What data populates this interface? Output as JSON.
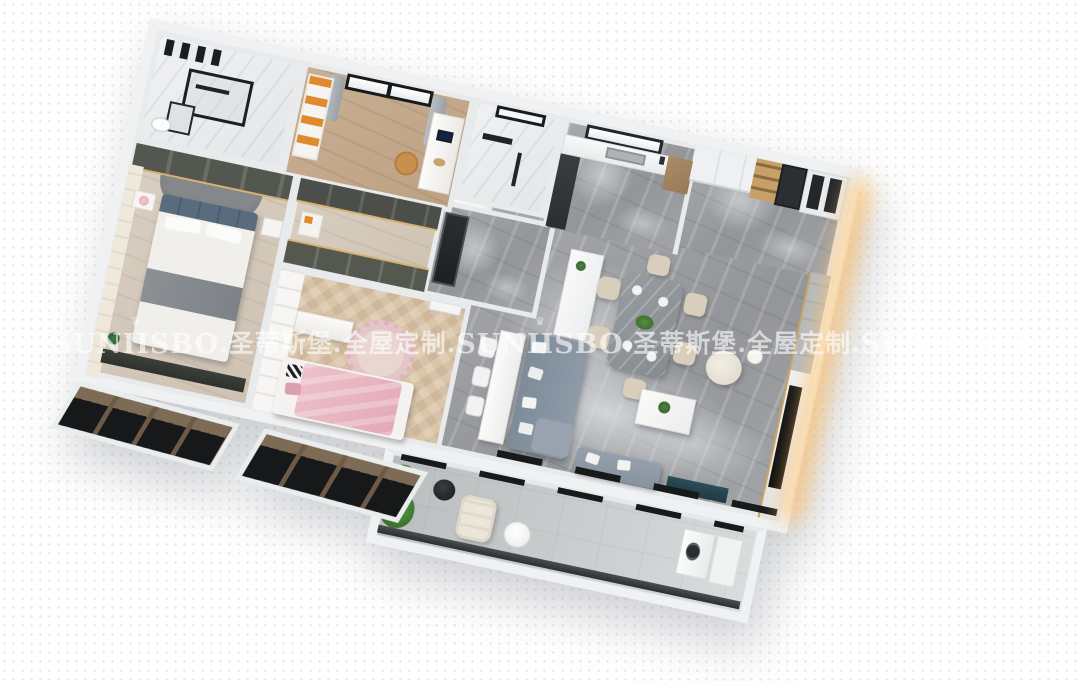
{
  "scene": {
    "kind": "3d-isometric-apartment-render",
    "background": "#ffffff",
    "rotation_deg": 12
  },
  "watermark": {
    "brand": "SUNIISBO",
    "crown_glyph": "♛",
    "cn_segment": ".圣蒂斯堡.全屋定制.",
    "color": "rgba(255,255,255,0.62)"
  },
  "regions": [
    {
      "name": "bathroom-main",
      "floor": "#ecedee"
    },
    {
      "name": "study-room",
      "floor": "#c9af92"
    },
    {
      "name": "second-bathroom",
      "floor": "#ecedee"
    },
    {
      "name": "kitchen",
      "floor": "#a6a8ab"
    },
    {
      "name": "pantry-fridge-wall",
      "floor": "#a6a8ab"
    },
    {
      "name": "dining-area",
      "floor": "#a6a8ab"
    },
    {
      "name": "living-area",
      "floor": "#a6a8ab"
    },
    {
      "name": "entry-hall",
      "floor": "#a6a8ab"
    },
    {
      "name": "walk-in-closet",
      "floor": "#cec2b2"
    },
    {
      "name": "master-bedroom",
      "floor": "#d9cfc2"
    },
    {
      "name": "kids-bedroom",
      "floor": "#dbc5a9"
    },
    {
      "name": "balcony",
      "floor": "#c4c7c8"
    }
  ],
  "colors": {
    "outer_wall": "#eff1f2",
    "inner_wall": "#e8eaeb",
    "marble_floor": "#9b9d9f",
    "sofa": "#8794a2",
    "sofa_pillow": "#f4f4f2",
    "dining_table": "#8f9499",
    "dining_chair": "#d8ccba",
    "island": "#f7f7f5",
    "fridge_glass": "#24272a",
    "gold_accent": "#c9a265",
    "led_glow": "#ffc676",
    "master_headboard": "#5a6b7d",
    "wardrobe_smoked": "#4b4e49",
    "kids_pink": "#e9b7c1",
    "kids_rug": "#e8d4cf",
    "plant_green": "#3f7a33",
    "bay_window_bronze": "#6d5b47",
    "bay_window_glass": "#16181a",
    "balcony_floor": "#c4c7c8"
  }
}
